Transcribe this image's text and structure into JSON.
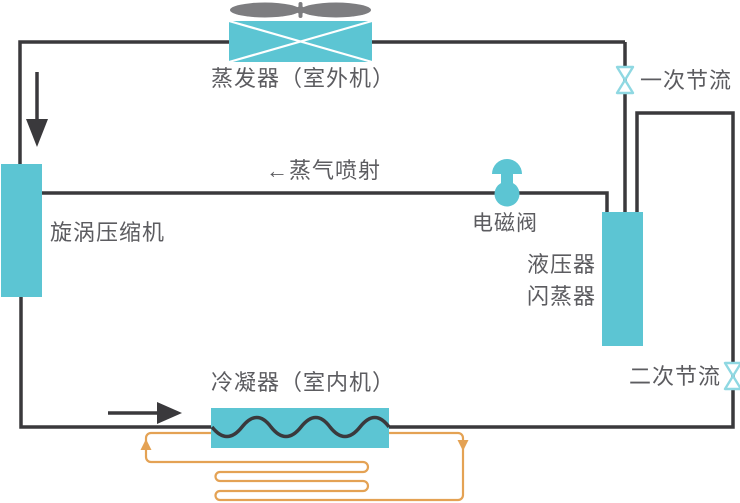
{
  "diagram_title": "蒸气喷射热泵系统原理图",
  "labels": {
    "evaporator": "蒸发器（室外机）",
    "primary_throttle": "一次节流",
    "vapor_injection": "←蒸气喷射",
    "solenoid_valve": "电磁阀",
    "compressor": "旋涡压缩机",
    "accumulator": "液压器",
    "flash_tank": "闪蒸器",
    "secondary_throttle": "二次节流",
    "condenser": "冷凝器（室内机）"
  },
  "icons": {
    "fan": "fan-propeller-icon",
    "evaporator_coil": "crossed-heat-exchanger-icon",
    "condenser_coil": "wavy-coil-icon",
    "throttle_valve": "bowtie-valve-icon",
    "solenoid": "mushroom-valve-icon",
    "flow_arrows": "black-flow-arrows",
    "water_loop": "orange-floor-heating-loop"
  },
  "colors": {
    "component_fill": "#5cc5d3",
    "valve_stroke": "#8fd8e2",
    "pipe": "#3a393c",
    "water_loop": "#e4a254",
    "fan": "#7d7d80",
    "text": "#5c5c60",
    "background": "#ffffff"
  }
}
